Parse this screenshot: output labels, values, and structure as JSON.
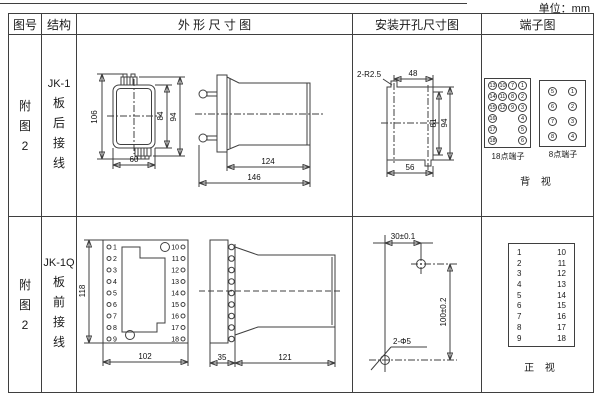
{
  "unit_label": "单位：mm",
  "colors": {
    "ink": "#3f3f3f"
  },
  "header": {
    "figure": "图号",
    "structure": "结构",
    "outline": "外 形 尺 寸 图",
    "install": "安装开孔尺寸图",
    "terminal": "端子图"
  },
  "row1": {
    "figure": "附\n图\n2",
    "model": "JK-1",
    "mount": "板\n后\n接\n线",
    "outline": {
      "d106": "106",
      "d84": "84",
      "d94": "94",
      "d60": "60",
      "d124": "124",
      "d146": "146"
    },
    "install": {
      "callout": "2-R2.5",
      "d48": "48",
      "d81": "81",
      "d94": "94",
      "d56": "56"
    },
    "terminal": {
      "grid18": [
        [
          "13",
          "10",
          "7",
          "1"
        ],
        [
          "14",
          "11",
          "8",
          "2"
        ],
        [
          "15",
          "12",
          "9",
          "3"
        ],
        [
          "16",
          "",
          "",
          "4"
        ],
        [
          "17",
          "",
          "",
          "5"
        ],
        [
          "18",
          "",
          "",
          "6"
        ]
      ],
      "grid8": [
        [
          "5",
          "1"
        ],
        [
          "6",
          "2"
        ],
        [
          "7",
          "3"
        ],
        [
          "8",
          "4"
        ]
      ],
      "label18": "18点端子",
      "label8": "8点端子",
      "view": "背  视"
    }
  },
  "row2": {
    "figure": "附\n图\n2",
    "model": "JK-1Q",
    "mount": "板\n前\n接\n线",
    "outline": {
      "d118": "118",
      "d102": "102",
      "d35": "35",
      "d121": "121",
      "left": [
        "1",
        "2",
        "3",
        "4",
        "5",
        "6",
        "7",
        "8",
        "9"
      ],
      "right": [
        "10",
        "11",
        "12",
        "13",
        "14",
        "15",
        "16",
        "17",
        "18"
      ]
    },
    "install": {
      "dx": "30±0.1",
      "dy": "100±0.2",
      "callout": "2-Φ5"
    },
    "terminal": {
      "left": [
        "1",
        "2",
        "3",
        "4",
        "5",
        "6",
        "7",
        "8",
        "9"
      ],
      "right": [
        "10",
        "11",
        "12",
        "13",
        "14",
        "15",
        "16",
        "17",
        "18"
      ],
      "view": "正  视"
    }
  }
}
